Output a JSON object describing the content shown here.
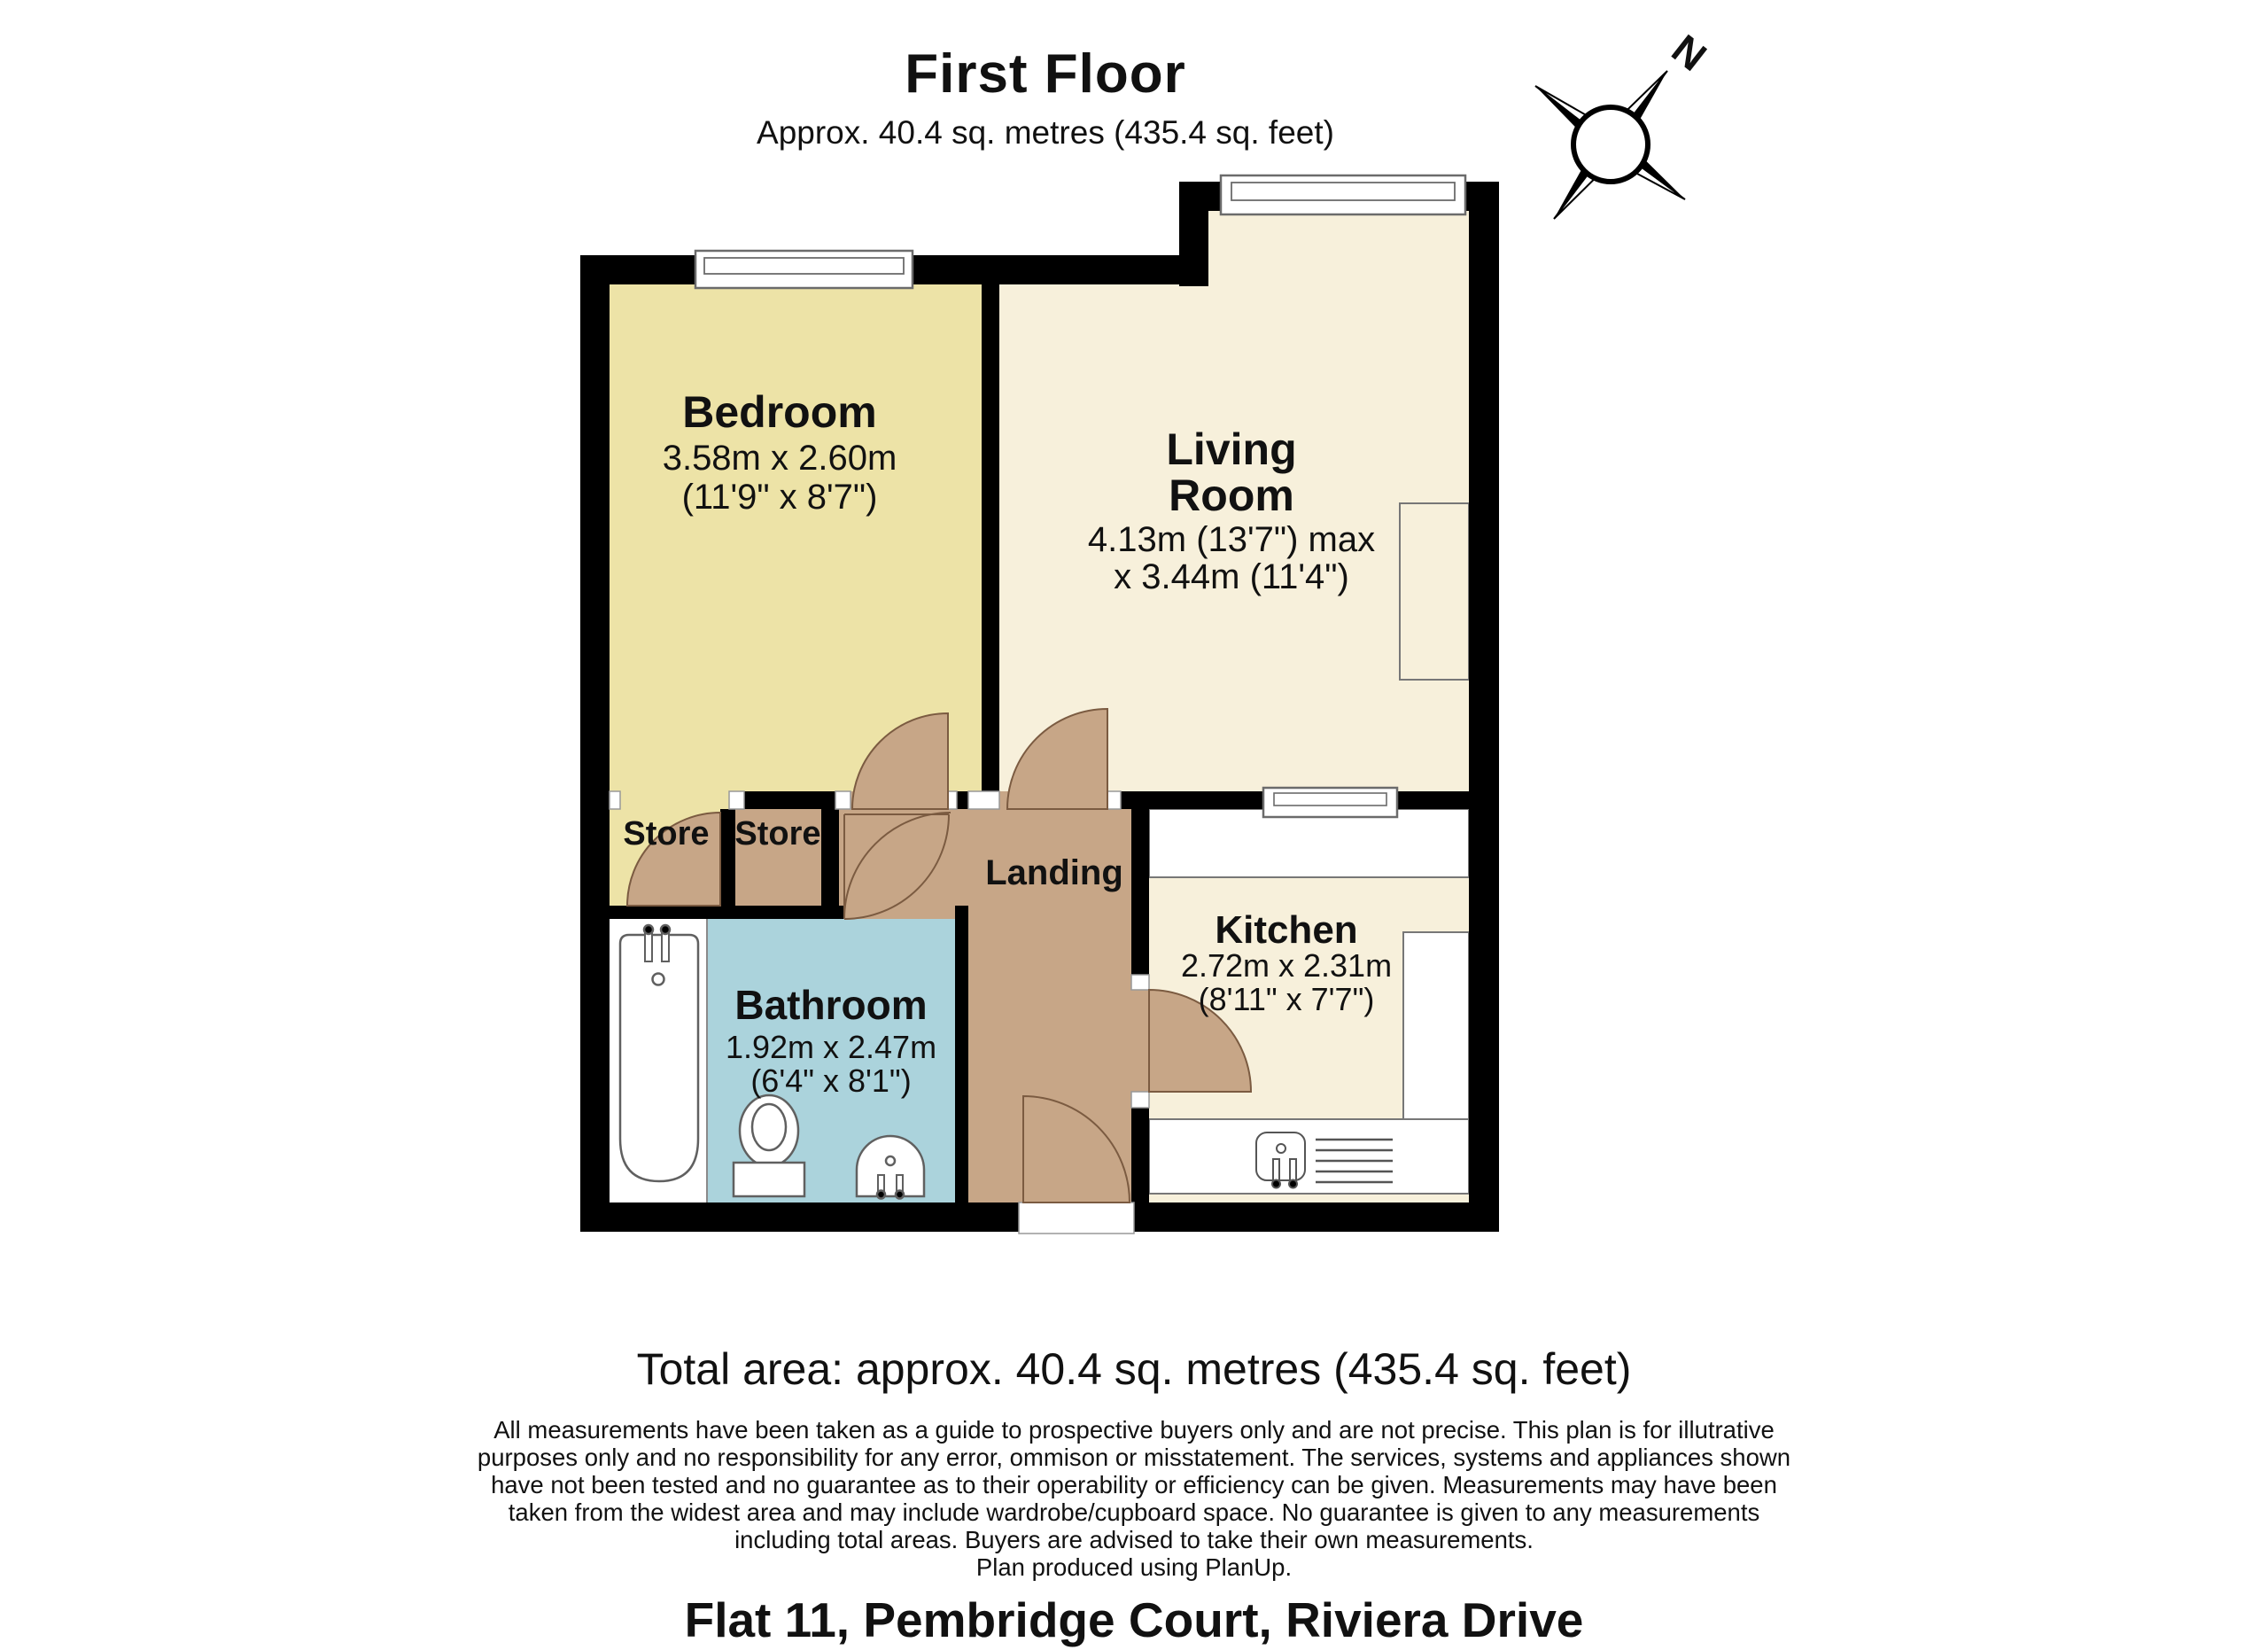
{
  "header": {
    "title": "First Floor",
    "subtitle": "Approx. 40.4 sq. metres (435.4 sq. feet)"
  },
  "compass": {
    "label": "N"
  },
  "rooms": {
    "bedroom": {
      "name": "Bedroom",
      "dim_metric": "3.58m x 2.60m",
      "dim_imperial": "(11'9\" x 8'7\")"
    },
    "living_room": {
      "name_line1": "Living",
      "name_line2": "Room",
      "dim_line1": "4.13m (13'7\") max",
      "dim_line2": "x 3.44m (11'4\")"
    },
    "kitchen": {
      "name": "Kitchen",
      "dim_metric": "2.72m x 2.31m",
      "dim_imperial": "(8'11\" x 7'7\")"
    },
    "bathroom": {
      "name": "Bathroom",
      "dim_metric": "1.92m x 2.47m",
      "dim_imperial": "(6'4\" x 8'1\")"
    },
    "landing": {
      "name": "Landing"
    },
    "store_left": {
      "name": "Store"
    },
    "store_right": {
      "name": "Store"
    }
  },
  "footer": {
    "total_area": "Total area: approx. 40.4 sq. metres (435.4 sq. feet)",
    "disclaimer_lines": [
      "All measurements have been taken as a guide to prospective buyers only and are not precise. This plan is for illutrative",
      "purposes only and no responsibility for any error, ommison or misstatement. The services, systems and appliances shown",
      "have not been tested and no guarantee as to their operability or efficiency can be given. Measurements may have been",
      "taken from the widest area and may include wardrobe/cupboard space. No guarantee is given to any measurements",
      "including total areas. Buyers are advised to take their own measurements.",
      "Plan produced using PlanUp."
    ],
    "address": "Flat 11, Pembridge Court, Riviera Drive"
  },
  "colors": {
    "wall": "#000000",
    "bedroom_fill": "#EDE3A7",
    "living_fill": "#F7F0DB",
    "landing_fill": "#C7A687",
    "bathroom_fill": "#ABD3DC",
    "fixture_white": "#FFFFFF",
    "door_outline": "#7B5B41",
    "fixture_outline": "#606060"
  }
}
